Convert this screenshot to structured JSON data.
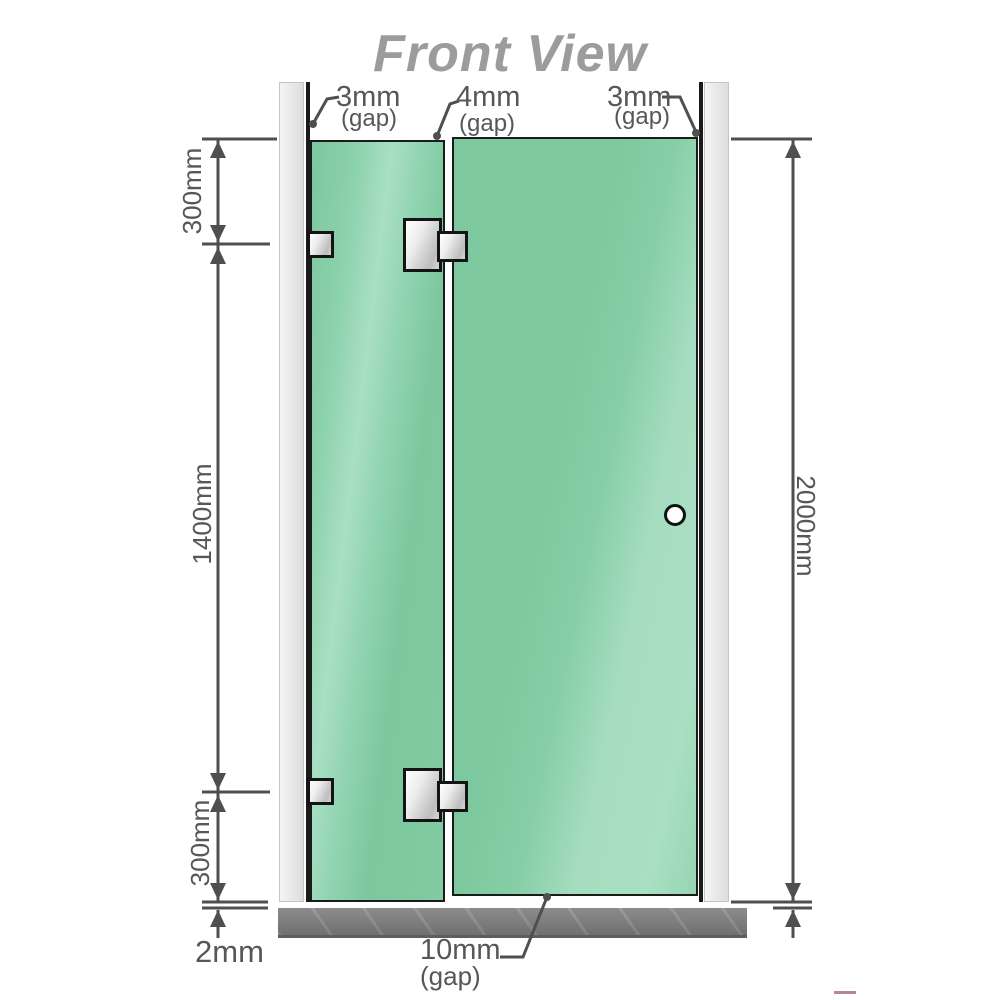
{
  "title": "Front View",
  "labels": {
    "gap_left": {
      "value": "3mm",
      "unit": "(gap)"
    },
    "gap_middle": {
      "value": "4mm",
      "unit": "(gap)"
    },
    "gap_right": {
      "value": "3mm",
      "unit": "(gap)"
    },
    "height_top": "300mm",
    "height_middle": "1400mm",
    "height_bottom": "300mm",
    "total_height": "2000mm",
    "floor_gap": "2mm",
    "door_bottom_gap": {
      "value": "10mm",
      "unit": "(gap)"
    }
  },
  "colors": {
    "glass": "#7ec9a0",
    "glass_highlight": "#a6ddc0",
    "wall_post": "#ececec",
    "floor": "#7f7f7f",
    "dimension_lines": "#4f4f4f",
    "dimension_text": "#575757",
    "title_text": "#9c9c9c",
    "hardware": "#d9d9d9"
  }
}
